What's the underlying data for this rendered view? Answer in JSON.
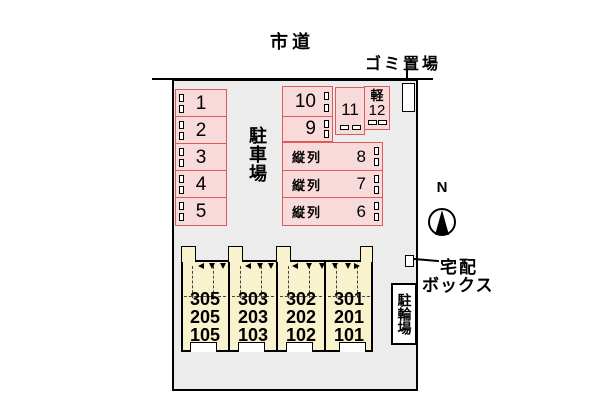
{
  "colors": {
    "site_background": "#ececec",
    "parking_fill": "#f9dada",
    "parking_border": "#dc5a5a",
    "building_fill": "#f8f3cd",
    "line": "#000000"
  },
  "top": {
    "road_label": "市道",
    "garbage_label": "ゴミ置場"
  },
  "site": {
    "parking_area_label": "駐車場",
    "left_spaces": [
      "1",
      "2",
      "3",
      "4",
      "5"
    ],
    "top_spaces": [
      "10",
      "9"
    ],
    "vertical_space_number": "11",
    "kei_space": {
      "type_label": "軽",
      "number": "12"
    },
    "tandem_spaces": [
      {
        "label": "縦列",
        "number": "8"
      },
      {
        "label": "縦列",
        "number": "7"
      },
      {
        "label": "縦列",
        "number": "6"
      }
    ]
  },
  "building": {
    "units": [
      {
        "floors": [
          "305",
          "205",
          "105"
        ]
      },
      {
        "floors": [
          "303",
          "203",
          "103"
        ]
      },
      {
        "floors": [
          "302",
          "202",
          "102"
        ]
      },
      {
        "floors": [
          "301",
          "201",
          "101"
        ]
      }
    ]
  },
  "right": {
    "compass_label": "N",
    "delivery_label_line1": "宅配",
    "delivery_label_line2": "ボックス",
    "bicycle_label": "駐輪場"
  }
}
